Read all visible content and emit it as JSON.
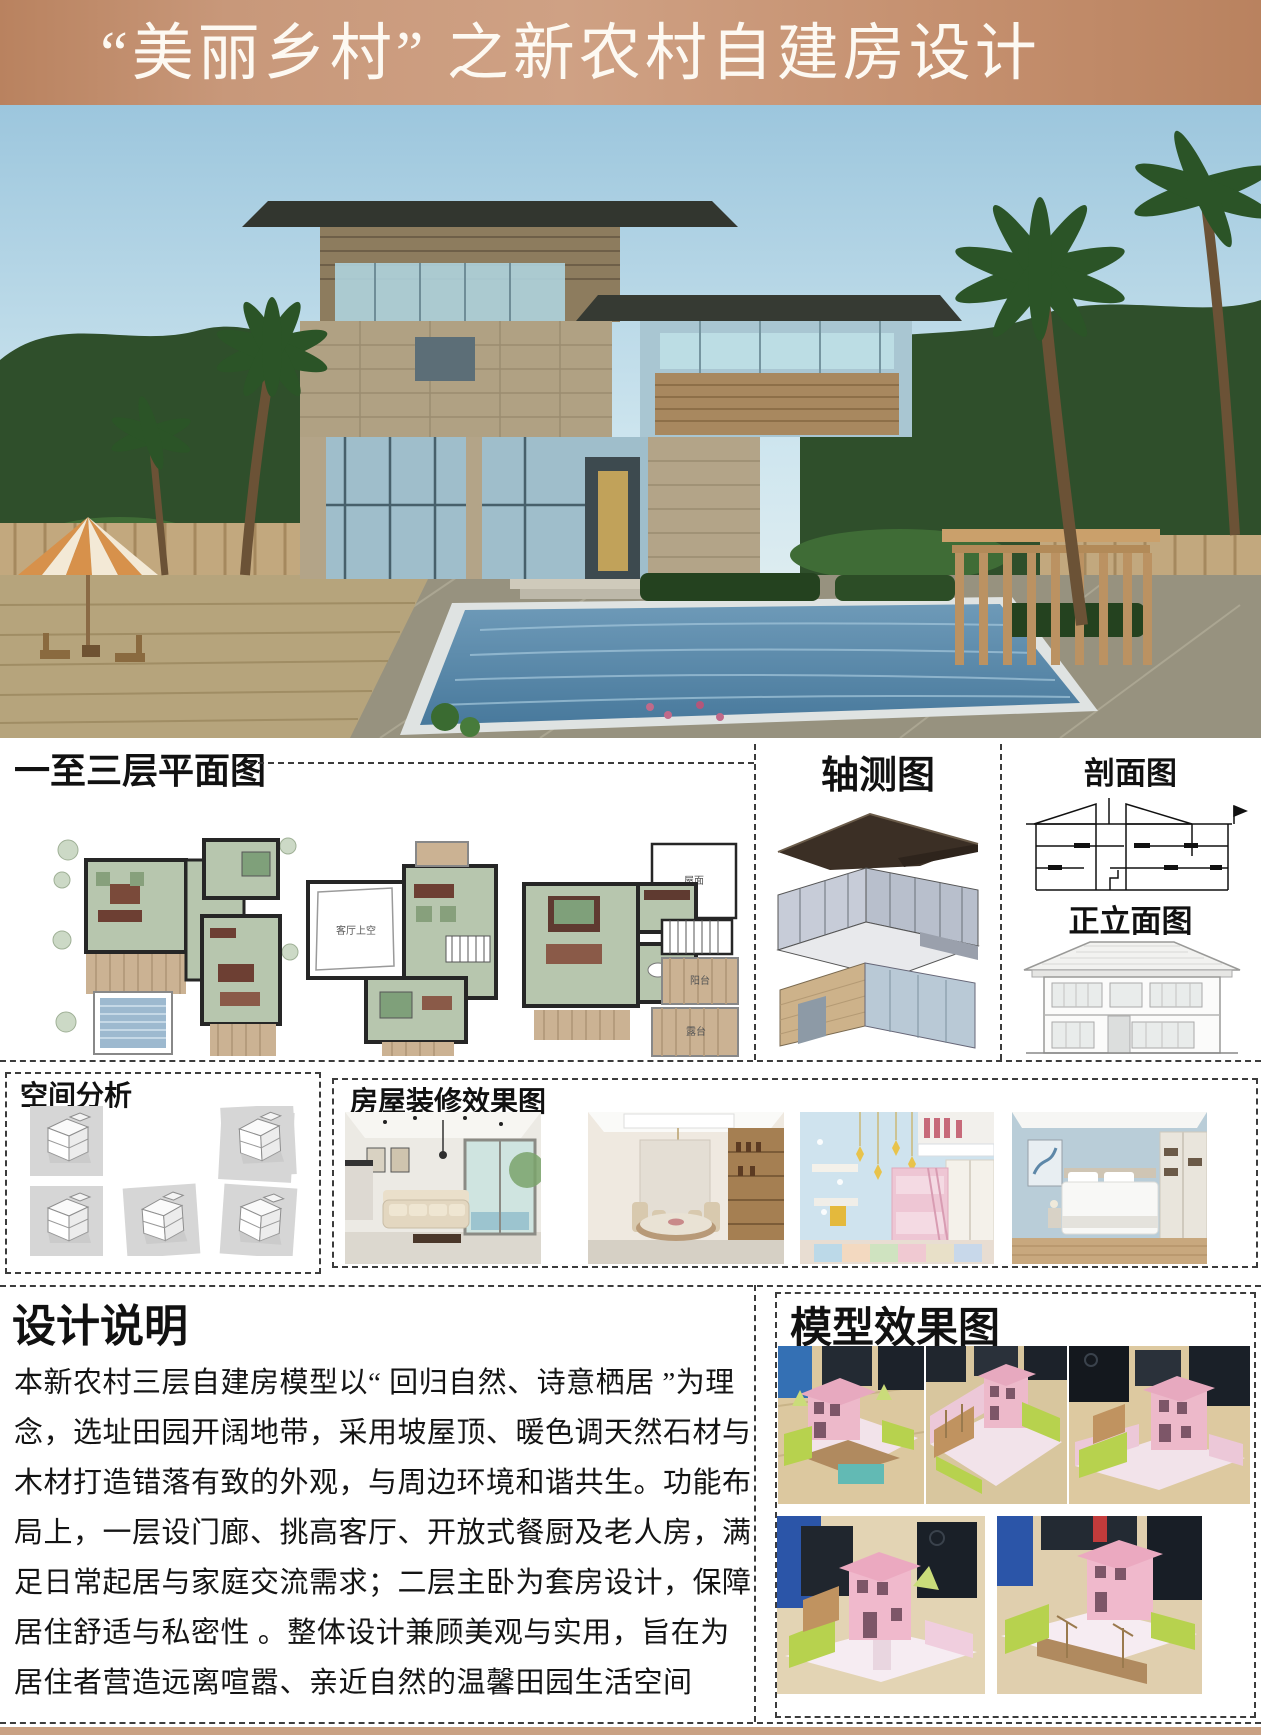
{
  "banner": {
    "title": "“美丽乡村” 之新农村自建房设计",
    "bg_color_left": "#b9825f",
    "bg_color_mid": "#cfa184",
    "text_color": "#fdf9f2"
  },
  "plans": {
    "title": "一至三层平面图",
    "labels": {
      "void": "客厅上空",
      "roof": "屋面",
      "balcony": "阳台",
      "terrace": "露台"
    }
  },
  "axon": {
    "title": "轴测图"
  },
  "section_view": {
    "title": "剖面图"
  },
  "elevation": {
    "title": "正立面图"
  },
  "spatial": {
    "title": "空间分析",
    "thumbnail_count": 6
  },
  "interior": {
    "title": "房屋装修效果图",
    "photo_count": 4
  },
  "description": {
    "title": "设计说明",
    "lines": [
      "本新农村三层自建房模型以“ 回归自然、诗意栖居 ”为理",
      "念，选址田园开阔地带，采用坡屋顶、暖色调天然石材与",
      "木材打造错落有致的外观，与周边环境和谐共生。功能布",
      "局上，一层设门廊、挑高客厅、开放式餐厨及老人房，满",
      "足日常起居与家庭交流需求；二层主卧为套房设计，保障",
      "居住舒适与私密性 。整体设计兼顾美观与实用，旨在为",
      "居住者营造远离喧嚣、亲近自然的温馨田园生活空间"
    ]
  },
  "model": {
    "title": "模型效果图",
    "photo_count": 5
  },
  "footer": {
    "bar_color": "#c9a183"
  }
}
